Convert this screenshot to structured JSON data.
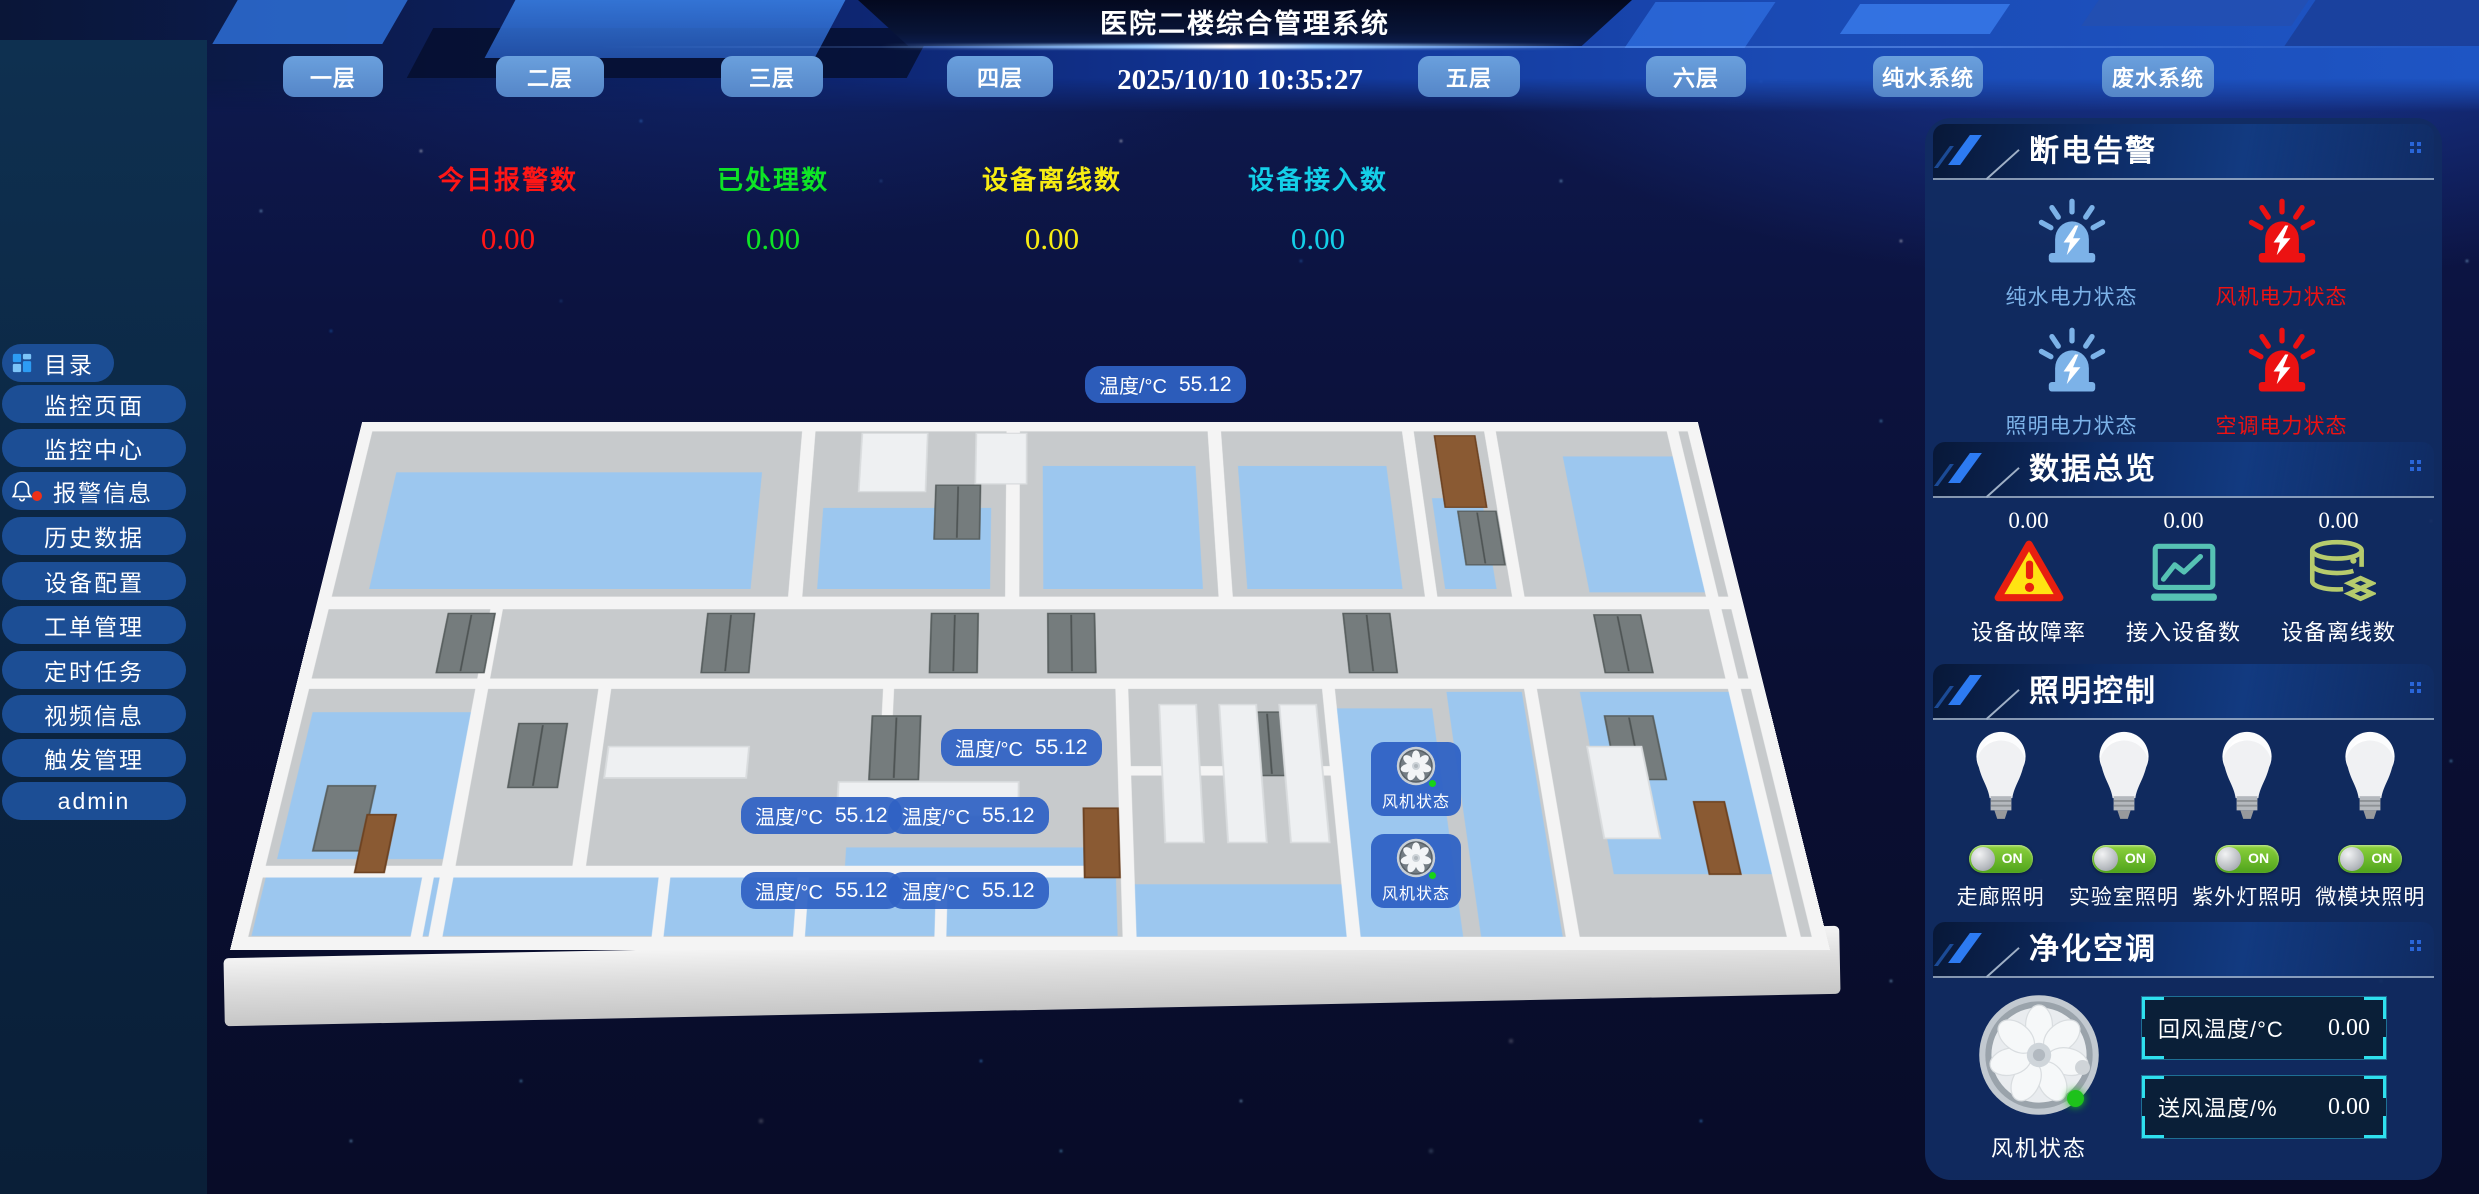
{
  "header": {
    "title": "医院二楼综合管理系统",
    "datetime": "2025/10/10 10:35:27",
    "tabs": [
      "一层",
      "二层",
      "三层",
      "四层",
      "五层",
      "六层",
      "纯水系统",
      "废水系统"
    ]
  },
  "stats": [
    {
      "label": "今日报警数",
      "value": "0.00",
      "color": "#ff1616"
    },
    {
      "label": "已处理数",
      "value": "0.00",
      "color": "#0ee426"
    },
    {
      "label": "设备离线数",
      "value": "0.00",
      "color": "#f7ec13"
    },
    {
      "label": "设备接入数",
      "value": "0.00",
      "color": "#14cfe8"
    }
  ],
  "sidebar": {
    "items": [
      "目录",
      "监控页面",
      "监控中心",
      "报警信息",
      "历史数据",
      "设备配置",
      "工单管理",
      "定时任务",
      "视频信息",
      "触发管理",
      "admin"
    ]
  },
  "floorplan": {
    "temp_labels": [
      {
        "text": "温度/°C",
        "value": "55.12"
      },
      {
        "text": "温度/°C",
        "value": "55.12"
      },
      {
        "text": "温度/°C",
        "value": "55.12"
      },
      {
        "text": "温度/°C",
        "value": "55.12"
      },
      {
        "text": "温度/°C",
        "value": "55.12"
      },
      {
        "text": "温度/°C",
        "value": "55.12"
      }
    ],
    "fan_badges": [
      {
        "label": "风机状态"
      },
      {
        "label": "风机状态"
      }
    ]
  },
  "panels": {
    "power_alarm": {
      "title": "断电告警",
      "items": [
        {
          "label": "纯水电力状态",
          "status": "normal",
          "color": "#7cb2e8"
        },
        {
          "label": "风机电力状态",
          "status": "alarm",
          "color": "#ec1212"
        },
        {
          "label": "照明电力状态",
          "status": "normal",
          "color": "#7cb2e8"
        },
        {
          "label": "空调电力状态",
          "status": "alarm",
          "color": "#ec1212"
        }
      ]
    },
    "data_overview": {
      "title": "数据总览",
      "items": [
        {
          "label": "设备故障率",
          "value": "0.00"
        },
        {
          "label": "接入设备数",
          "value": "0.00"
        },
        {
          "label": "设备离线数",
          "value": "0.00"
        }
      ]
    },
    "lighting": {
      "title": "照明控制",
      "items": [
        {
          "label": "走廊照明",
          "state": "ON"
        },
        {
          "label": "实验室照明",
          "state": "ON"
        },
        {
          "label": "紫外灯照明",
          "state": "ON"
        },
        {
          "label": "微模块照明",
          "state": "ON"
        }
      ]
    },
    "hvac": {
      "title": "净化空调",
      "fan_label": "风机状态",
      "readings": [
        {
          "label": "回风温度/°C",
          "value": "0.00"
        },
        {
          "label": "送风温度/%",
          "value": "0.00"
        }
      ]
    }
  }
}
